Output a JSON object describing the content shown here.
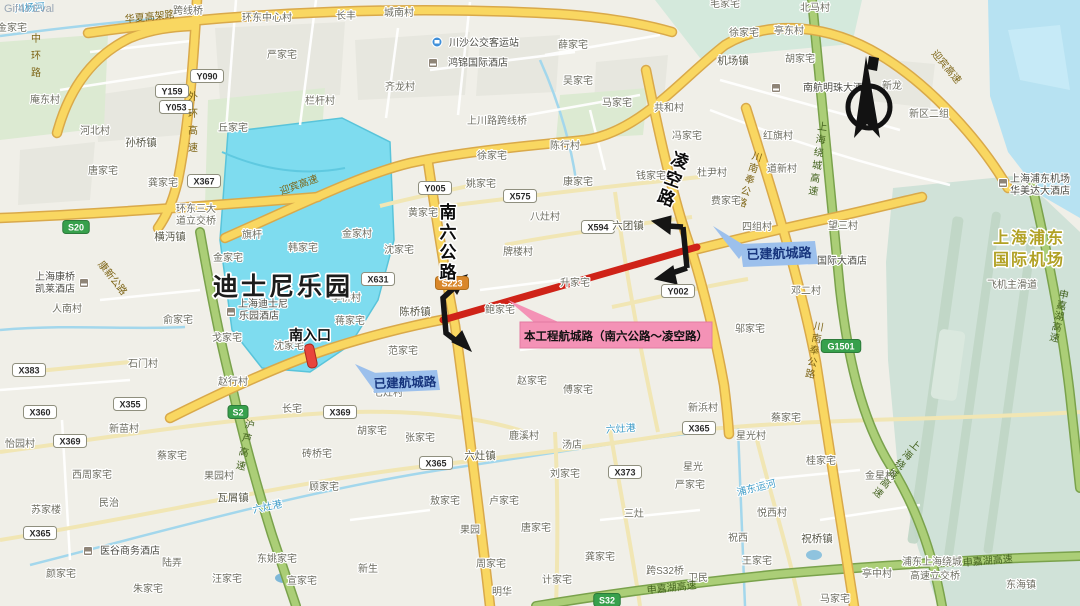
{
  "watermark": "Gif4J Eval",
  "colors": {
    "disney_fill": "#7edcef",
    "route_red": "#cf2318",
    "callout_pink": "#f492b6",
    "callout_blue": "#9cc0ec",
    "road_yellow": "#f9d761",
    "expressway_green": "#abce77",
    "water_blue": "#a3d7ec",
    "airport_fill": "#d0e2d8"
  },
  "callouts": {
    "project": {
      "label": "本工程航城路（南六公路～凌空路）"
    },
    "built_west": {
      "label": "已建航城路"
    },
    "built_east": {
      "label": "已建航城路"
    }
  },
  "map": {
    "labels": [
      {
        "t": "川杨河",
        "x": 30,
        "y": 11,
        "c": "w",
        "r": -4
      },
      {
        "t": "金家宅",
        "x": 12,
        "y": 31,
        "c": "v"
      },
      {
        "t": "中环路",
        "x": 36,
        "y": 42,
        "c": "ry",
        "v": 1,
        "fs": 11,
        "dy": 17
      },
      {
        "t": "华夏高架路",
        "x": 150,
        "y": 20,
        "c": "ry",
        "r": -6
      },
      {
        "t": "跨线桥",
        "x": 188,
        "y": 14,
        "c": "v"
      },
      {
        "t": "环东中心村",
        "x": 267,
        "y": 21,
        "c": "v"
      },
      {
        "t": "长丰",
        "x": 346,
        "y": 19,
        "c": "v"
      },
      {
        "t": "城南村",
        "x": 399,
        "y": 16,
        "c": "v"
      },
      {
        "t": "严家宅",
        "x": 282,
        "y": 58,
        "c": "v"
      },
      {
        "t": "薛家宅",
        "x": 573,
        "y": 48,
        "c": "v"
      },
      {
        "t": "毛家宅",
        "x": 725,
        "y": 7,
        "c": "v"
      },
      {
        "t": "北马村",
        "x": 815,
        "y": 11,
        "c": "v"
      },
      {
        "t": "徐家宅",
        "x": 744,
        "y": 36,
        "c": "v"
      },
      {
        "t": "亭东村",
        "x": 789,
        "y": 34,
        "c": "v"
      },
      {
        "t": "庵东村",
        "x": 45,
        "y": 103,
        "c": "v"
      },
      {
        "t": "齐龙村",
        "x": 400,
        "y": 90,
        "c": "v"
      },
      {
        "t": "吴家宅",
        "x": 578,
        "y": 84,
        "c": "v"
      },
      {
        "t": "机场镇",
        "x": 733,
        "y": 64,
        "c": "t"
      },
      {
        "t": "胡家宅",
        "x": 800,
        "y": 62,
        "c": "v"
      },
      {
        "t": "新龙",
        "x": 892,
        "y": 89,
        "c": "v"
      },
      {
        "t": "新区二组",
        "x": 929,
        "y": 117,
        "c": "v"
      },
      {
        "t": "外环高速",
        "x": 193,
        "y": 100,
        "c": "ry",
        "v": 1,
        "dy": 17
      },
      {
        "t": "栏杆村",
        "x": 320,
        "y": 104,
        "c": "v"
      },
      {
        "t": "丘家宅",
        "x": 233,
        "y": 131,
        "c": "v"
      },
      {
        "t": "河北村",
        "x": 95,
        "y": 134,
        "c": "v"
      },
      {
        "t": "孙桥镇",
        "x": 141,
        "y": 146,
        "c": "t"
      },
      {
        "t": "唐家宅",
        "x": 103,
        "y": 174,
        "c": "v"
      },
      {
        "t": "龚家宅",
        "x": 163,
        "y": 186,
        "c": "v"
      },
      {
        "t": "环东三大",
        "x": 196,
        "y": 212,
        "c": "v"
      },
      {
        "t": "道立交桥",
        "x": 196,
        "y": 224,
        "c": "v"
      },
      {
        "t": "迎宾高速",
        "x": 300,
        "y": 188,
        "c": "ry",
        "r": -20
      },
      {
        "t": "迎宾高速",
        "x": 944,
        "y": 69,
        "c": "ry",
        "r": 50
      },
      {
        "t": "横沔镇",
        "x": 170,
        "y": 240,
        "c": "t"
      },
      {
        "t": "马家宅",
        "x": 617,
        "y": 106,
        "c": "v"
      },
      {
        "t": "共和村",
        "x": 669,
        "y": 111,
        "c": "v"
      },
      {
        "t": "冯家宅",
        "x": 687,
        "y": 139,
        "c": "v"
      },
      {
        "t": "红旗村",
        "x": 778,
        "y": 139,
        "c": "v"
      },
      {
        "t": "道新村",
        "x": 782,
        "y": 172,
        "c": "v"
      },
      {
        "t": "上海绕城高速",
        "x": 822,
        "y": 130,
        "c": "rg",
        "v": 1,
        "r": 8,
        "dy": 13
      },
      {
        "t": "川南奉公路",
        "x": 756,
        "y": 160,
        "c": "ry",
        "v": 1,
        "r": 18,
        "dy": 12
      },
      {
        "t": "钱家宅",
        "x": 651,
        "y": 179,
        "c": "v"
      },
      {
        "t": "杜尹村",
        "x": 712,
        "y": 176,
        "c": "v"
      },
      {
        "t": "费家宅",
        "x": 726,
        "y": 204,
        "c": "v"
      },
      {
        "t": "徐家宅",
        "x": 492,
        "y": 159,
        "c": "v"
      },
      {
        "t": "陈行村",
        "x": 565,
        "y": 149,
        "c": "v"
      },
      {
        "t": "上川路跨线桥",
        "x": 497,
        "y": 124,
        "c": "v"
      },
      {
        "t": "姚家宅",
        "x": 481,
        "y": 187,
        "c": "v"
      },
      {
        "t": "康家宅",
        "x": 578,
        "y": 185,
        "c": "v"
      },
      {
        "t": "黄家宅",
        "x": 423,
        "y": 216,
        "c": "v"
      },
      {
        "t": "八灶村",
        "x": 545,
        "y": 220,
        "c": "v"
      },
      {
        "t": "牌楼村",
        "x": 518,
        "y": 255,
        "c": "v"
      },
      {
        "t": "六团镇",
        "x": 628,
        "y": 229,
        "c": "t"
      },
      {
        "t": "望三村",
        "x": 843,
        "y": 229,
        "c": "v"
      },
      {
        "t": "四组村",
        "x": 757,
        "y": 230,
        "c": "v"
      },
      {
        "t": "邓二村",
        "x": 806,
        "y": 294,
        "c": "v"
      },
      {
        "t": "邬家宅",
        "x": 750,
        "y": 332,
        "c": "v"
      },
      {
        "t": "旗杆",
        "x": 252,
        "y": 238,
        "c": "v"
      },
      {
        "t": "韩家宅",
        "x": 303,
        "y": 251,
        "c": "v"
      },
      {
        "t": "金家村",
        "x": 357,
        "y": 237,
        "c": "v"
      },
      {
        "t": "金家宅",
        "x": 228,
        "y": 261,
        "c": "v"
      },
      {
        "t": "沈家宅",
        "x": 399,
        "y": 253,
        "c": "v"
      },
      {
        "t": "李桥村",
        "x": 346,
        "y": 301,
        "c": "v"
      },
      {
        "t": "蒋家宅",
        "x": 350,
        "y": 324,
        "c": "v"
      },
      {
        "t": "沈家宅",
        "x": 289,
        "y": 349,
        "c": "v"
      },
      {
        "t": "人南村",
        "x": 67,
        "y": 312,
        "c": "v"
      },
      {
        "t": "俞家宅",
        "x": 178,
        "y": 323,
        "c": "v"
      },
      {
        "t": "戈家宅",
        "x": 227,
        "y": 341,
        "c": "v"
      },
      {
        "t": "石门村",
        "x": 143,
        "y": 367,
        "c": "v"
      },
      {
        "t": "康新公路",
        "x": 110,
        "y": 280,
        "c": "ry",
        "r": 52
      },
      {
        "t": "赵行村",
        "x": 233,
        "y": 385,
        "c": "v"
      },
      {
        "t": "陈桥镇",
        "x": 415,
        "y": 315,
        "c": "t"
      },
      {
        "t": "范家宅",
        "x": 403,
        "y": 354,
        "c": "v"
      },
      {
        "t": "七灶村",
        "x": 388,
        "y": 396,
        "c": "v"
      },
      {
        "t": "鲍家宅",
        "x": 500,
        "y": 313,
        "c": "v"
      },
      {
        "t": "升家宅",
        "x": 575,
        "y": 286,
        "c": "v"
      },
      {
        "t": "赵家宅",
        "x": 532,
        "y": 384,
        "c": "v"
      },
      {
        "t": "傅家宅",
        "x": 578,
        "y": 393,
        "c": "v"
      },
      {
        "t": "长宅",
        "x": 292,
        "y": 412,
        "c": "v"
      },
      {
        "t": "新苗村",
        "x": 124,
        "y": 432,
        "c": "v"
      },
      {
        "t": "怡园村",
        "x": 20,
        "y": 447,
        "c": "v"
      },
      {
        "t": "西周家宅",
        "x": 92,
        "y": 478,
        "c": "v"
      },
      {
        "t": "蔡家宅",
        "x": 172,
        "y": 459,
        "c": "v"
      },
      {
        "t": "果园村",
        "x": 219,
        "y": 479,
        "c": "v"
      },
      {
        "t": "瓦屑镇",
        "x": 233,
        "y": 501,
        "c": "t"
      },
      {
        "t": "民治",
        "x": 109,
        "y": 506,
        "c": "v"
      },
      {
        "t": "苏家楼",
        "x": 46,
        "y": 513,
        "c": "v"
      },
      {
        "t": "陆弄",
        "x": 172,
        "y": 566,
        "c": "v"
      },
      {
        "t": "颜家宅",
        "x": 61,
        "y": 577,
        "c": "v"
      },
      {
        "t": "朱家宅",
        "x": 148,
        "y": 592,
        "c": "v"
      },
      {
        "t": "六灶港",
        "x": 268,
        "y": 510,
        "c": "w",
        "r": -12
      },
      {
        "t": "六灶港",
        "x": 621,
        "y": 432,
        "c": "w",
        "r": -4
      },
      {
        "t": "东姚家宅",
        "x": 277,
        "y": 562,
        "c": "v"
      },
      {
        "t": "汪家宅",
        "x": 227,
        "y": 582,
        "c": "v"
      },
      {
        "t": "宣家宅",
        "x": 302,
        "y": 584,
        "c": "v"
      },
      {
        "t": "砖桥宅",
        "x": 317,
        "y": 457,
        "c": "v"
      },
      {
        "t": "顾家宅",
        "x": 324,
        "y": 490,
        "c": "v"
      },
      {
        "t": "沪芦高速",
        "x": 249,
        "y": 428,
        "c": "rg",
        "v": 1,
        "r": 12,
        "dy": 14
      },
      {
        "t": "胡家宅",
        "x": 372,
        "y": 434,
        "c": "v"
      },
      {
        "t": "张家宅",
        "x": 420,
        "y": 441,
        "c": "v"
      },
      {
        "t": "鹿溪村",
        "x": 524,
        "y": 439,
        "c": "v"
      },
      {
        "t": "汤店",
        "x": 572,
        "y": 448,
        "c": "v"
      },
      {
        "t": "六灶镇",
        "x": 480,
        "y": 459,
        "c": "t"
      },
      {
        "t": "刘家宅",
        "x": 565,
        "y": 477,
        "c": "v"
      },
      {
        "t": "敖家宅",
        "x": 445,
        "y": 504,
        "c": "v"
      },
      {
        "t": "卢家宅",
        "x": 504,
        "y": 504,
        "c": "v"
      },
      {
        "t": "果园",
        "x": 470,
        "y": 533,
        "c": "v"
      },
      {
        "t": "唐家宅",
        "x": 536,
        "y": 531,
        "c": "v"
      },
      {
        "t": "周家宅",
        "x": 491,
        "y": 567,
        "c": "v"
      },
      {
        "t": "计家宅",
        "x": 557,
        "y": 583,
        "c": "v"
      },
      {
        "t": "明华",
        "x": 502,
        "y": 595,
        "c": "v"
      },
      {
        "t": "新生",
        "x": 368,
        "y": 572,
        "c": "v"
      },
      {
        "t": "龚家宅",
        "x": 600,
        "y": 560,
        "c": "v"
      },
      {
        "t": "三灶",
        "x": 634,
        "y": 517,
        "c": "v"
      },
      {
        "t": "星光",
        "x": 693,
        "y": 470,
        "c": "v"
      },
      {
        "t": "严家宅",
        "x": 690,
        "y": 488,
        "c": "v"
      },
      {
        "t": "新浜村",
        "x": 703,
        "y": 411,
        "c": "v"
      },
      {
        "t": "跨S32桥",
        "x": 665,
        "y": 574,
        "c": "v"
      },
      {
        "t": "卫民",
        "x": 698,
        "y": 581,
        "c": "v"
      },
      {
        "t": "申嘉湖高速",
        "x": 672,
        "y": 591,
        "c": "rg",
        "r": -6
      },
      {
        "t": "申嘉湖高速",
        "x": 988,
        "y": 564,
        "c": "rg",
        "r": -5
      },
      {
        "t": "申嘉湖高速",
        "x": 1063,
        "y": 298,
        "c": "rg",
        "v": 1,
        "r": 12,
        "dy": 11,
        "fs": 9.5
      },
      {
        "t": "王家宅",
        "x": 757,
        "y": 564,
        "c": "v"
      },
      {
        "t": "祝西",
        "x": 738,
        "y": 541,
        "c": "v"
      },
      {
        "t": "悦西村",
        "x": 772,
        "y": 516,
        "c": "v"
      },
      {
        "t": "祝桥镇",
        "x": 817,
        "y": 542,
        "c": "t"
      },
      {
        "t": "浦东运河",
        "x": 757,
        "y": 491,
        "c": "w",
        "r": -14
      },
      {
        "t": "星光村",
        "x": 751,
        "y": 439,
        "c": "v"
      },
      {
        "t": "蔡家宅",
        "x": 786,
        "y": 421,
        "c": "v"
      },
      {
        "t": "桂家宅",
        "x": 821,
        "y": 464,
        "c": "v"
      },
      {
        "t": "金星村",
        "x": 880,
        "y": 479,
        "c": "v"
      },
      {
        "t": "亭中村",
        "x": 877,
        "y": 577,
        "c": "v"
      },
      {
        "t": "浦东上海绕城",
        "x": 932,
        "y": 565,
        "c": "v"
      },
      {
        "t": "高速立交桥",
        "x": 935,
        "y": 579,
        "c": "v"
      },
      {
        "t": "东海镇",
        "x": 1021,
        "y": 588,
        "c": "v"
      },
      {
        "t": "马家宅",
        "x": 835,
        "y": 602,
        "c": "v"
      },
      {
        "t": "上海绕城高速",
        "x": 913,
        "y": 448,
        "c": "rg",
        "v": 1,
        "r": 38,
        "dy": 12
      },
      {
        "t": "川南奉公路",
        "x": 818,
        "y": 330,
        "c": "ry",
        "v": 1,
        "r": 10,
        "dy": 12
      },
      {
        "t": "飞机主滑道",
        "x": 1012,
        "y": 288,
        "c": "v"
      },
      {
        "t": "南六公路",
        "x": 448,
        "y": 218,
        "c": "rk",
        "v": 1,
        "dy": 20
      },
      {
        "t": "凌空路",
        "x": 678,
        "y": 166,
        "c": "rk",
        "v": 1,
        "r": 20,
        "dy": 20
      },
      {
        "t": "迪士尼乐园",
        "x": 283,
        "y": 295,
        "c": "disney"
      },
      {
        "t": "南入口",
        "x": 310,
        "y": 340,
        "c": "ent"
      },
      {
        "t": "上海浦东",
        "x": 1029,
        "y": 243,
        "c": "apt"
      },
      {
        "t": "国际机场",
        "x": 1029,
        "y": 265,
        "c": "apt"
      },
      {
        "t": "川沙公交客运站",
        "x": 484,
        "y": 46,
        "c": "poi"
      },
      {
        "t": "鸿锦国际酒店",
        "x": 478,
        "y": 66,
        "c": "poi"
      },
      {
        "t": "南航明珠大酒店",
        "x": 838,
        "y": 91,
        "c": "poi"
      },
      {
        "t": "上海浦东机场",
        "x": 1040,
        "y": 182,
        "c": "poi"
      },
      {
        "t": "华美达大酒店",
        "x": 1040,
        "y": 194,
        "c": "poi"
      },
      {
        "t": "国际大酒店",
        "x": 842,
        "y": 264,
        "c": "poi"
      },
      {
        "t": "上海迪士尼",
        "x": 263,
        "y": 307,
        "c": "poi"
      },
      {
        "t": "乐园酒店",
        "x": 259,
        "y": 319,
        "c": "poi"
      },
      {
        "t": "上海康桥",
        "x": 55,
        "y": 280,
        "c": "poi"
      },
      {
        "t": "凯莱酒店",
        "x": 55,
        "y": 292,
        "c": "poi"
      },
      {
        "t": "医谷商务酒店",
        "x": 130,
        "y": 554,
        "c": "poi"
      }
    ],
    "badges": [
      {
        "t": "Y090",
        "x": 207,
        "y": 76,
        "k": "w"
      },
      {
        "t": "Y159",
        "x": 172,
        "y": 91,
        "k": "w"
      },
      {
        "t": "Y053",
        "x": 176,
        "y": 107,
        "k": "w"
      },
      {
        "t": "X367",
        "x": 204,
        "y": 181,
        "k": "w"
      },
      {
        "t": "Y005",
        "x": 435,
        "y": 188,
        "k": "w"
      },
      {
        "t": "X575",
        "x": 520,
        "y": 196,
        "k": "w"
      },
      {
        "t": "X631",
        "x": 378,
        "y": 279,
        "k": "w"
      },
      {
        "t": "X594",
        "x": 598,
        "y": 227,
        "k": "w"
      },
      {
        "t": "Y002",
        "x": 678,
        "y": 291,
        "k": "w"
      },
      {
        "t": "X383",
        "x": 29,
        "y": 370,
        "k": "w"
      },
      {
        "t": "X360",
        "x": 40,
        "y": 412,
        "k": "w"
      },
      {
        "t": "X355",
        "x": 130,
        "y": 404,
        "k": "w"
      },
      {
        "t": "X369",
        "x": 70,
        "y": 441,
        "k": "w"
      },
      {
        "t": "X369",
        "x": 340,
        "y": 412,
        "k": "w"
      },
      {
        "t": "X365",
        "x": 40,
        "y": 533,
        "k": "w"
      },
      {
        "t": "X365",
        "x": 436,
        "y": 463,
        "k": "w"
      },
      {
        "t": "X365",
        "x": 699,
        "y": 428,
        "k": "w"
      },
      {
        "t": "X373",
        "x": 625,
        "y": 472,
        "k": "w"
      },
      {
        "t": "S20",
        "x": 76,
        "y": 227,
        "k": "g"
      },
      {
        "t": "S2",
        "x": 238,
        "y": 412,
        "k": "g"
      },
      {
        "t": "S32",
        "x": 607,
        "y": 600,
        "k": "g"
      },
      {
        "t": "G1501",
        "x": 841,
        "y": 346,
        "k": "g"
      },
      {
        "t": "S223",
        "x": 452,
        "y": 283,
        "k": "o"
      }
    ],
    "pois": [
      {
        "x": 437,
        "y": 42,
        "ty": "bus"
      },
      {
        "x": 433,
        "y": 63,
        "ty": "hotel"
      },
      {
        "x": 776,
        "y": 88,
        "ty": "hotel"
      },
      {
        "x": 1003,
        "y": 183,
        "ty": "hotel"
      },
      {
        "x": 804,
        "y": 260,
        "ty": "hotel"
      },
      {
        "x": 231,
        "y": 312,
        "ty": "hotel"
      },
      {
        "x": 84,
        "y": 283,
        "ty": "hotel"
      },
      {
        "x": 88,
        "y": 551,
        "ty": "hotel"
      }
    ]
  }
}
